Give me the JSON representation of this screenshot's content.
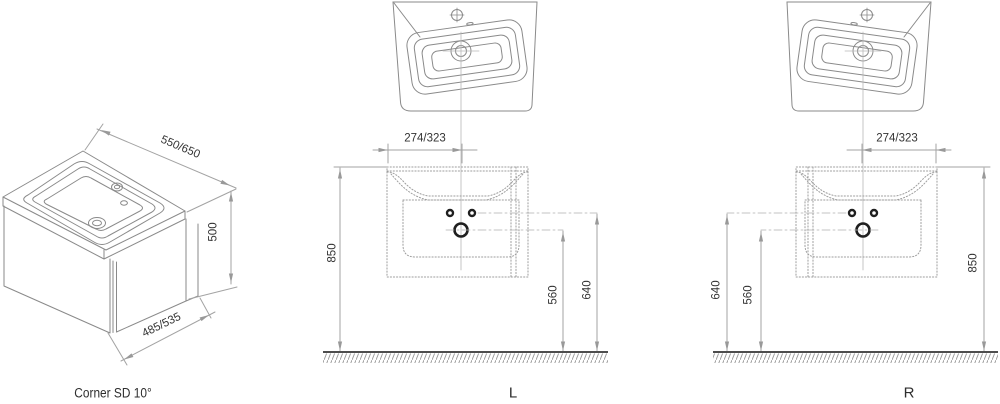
{
  "figures": {
    "corner": {
      "title": "Corner SD 10°",
      "width_dim": "550/650",
      "height_dim": "500",
      "depth_dim": "485/535"
    },
    "left": {
      "title": "L",
      "offset_dim": "274/323",
      "height_dim": "850",
      "drain_height_dim": "560",
      "supply_height_dim": "640"
    },
    "right": {
      "title": "R",
      "offset_dim": "274/323",
      "height_dim": "850",
      "drain_height_dim": "560",
      "supply_height_dim": "640"
    }
  },
  "colors": {
    "outline_gray": "#8a8a8a",
    "dim_line_gray": "#a3a3a3",
    "dotted_gray": "#9e9e9e",
    "centerline_gray": "#b8b8b8",
    "text": "#333333",
    "floor_dark": "#4d4d4d",
    "fitting_black": "#1f1f1f"
  }
}
